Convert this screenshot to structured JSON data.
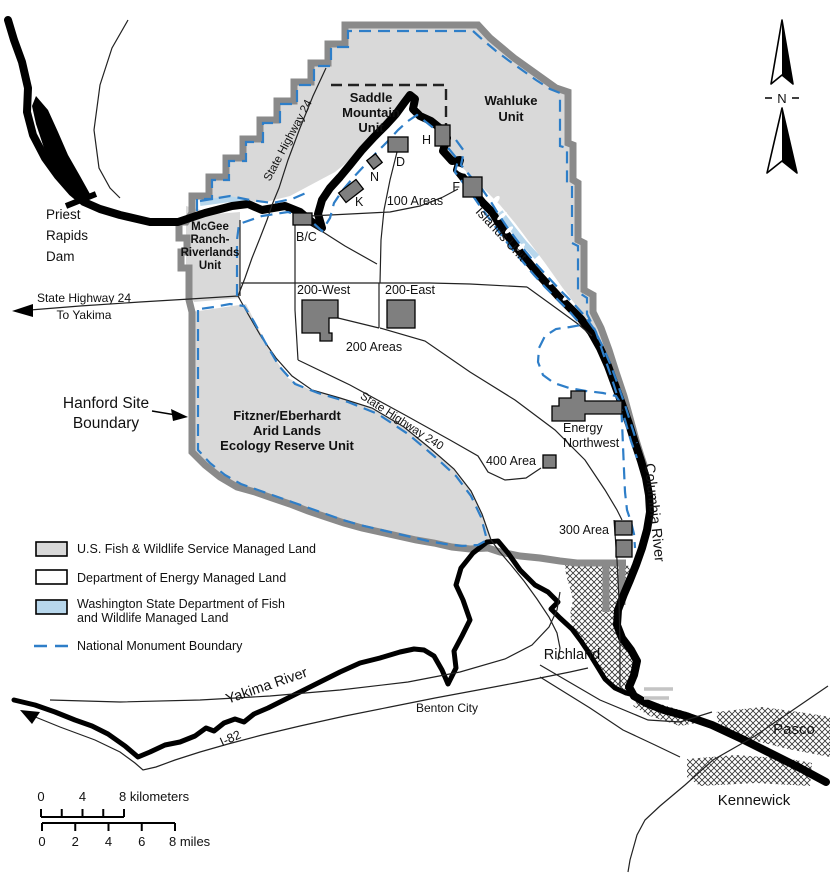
{
  "title": "Hanford Site map",
  "compass": {
    "n": "N"
  },
  "units": {
    "saddle": [
      "Saddle",
      "Mountain",
      "Unit"
    ],
    "wahluke": [
      "Wahluke",
      "Unit"
    ],
    "mcgee": [
      "McGee",
      "Ranch-",
      "Riverlands",
      "Unit"
    ],
    "fitzner": [
      "Fitzner/Eberhardt",
      "Arid Lands",
      "Ecology Reserve Unit"
    ],
    "islands": "Islands Unit"
  },
  "areas": {
    "a100": "100 Areas",
    "a200": "200 Areas",
    "w200": "200-West",
    "e200": "200-East",
    "a400": "400 Area",
    "a300": "300 Area",
    "energy": [
      "Energy",
      "Northwest"
    ],
    "reactors": {
      "bc": "B/C",
      "k": "K",
      "n": "N",
      "d": "D",
      "h": "H",
      "f": "F"
    }
  },
  "water": {
    "columbia": "Columbia River",
    "yakima": "Yakima River",
    "dam": [
      "Priest",
      "Rapids",
      "Dam"
    ]
  },
  "roads": {
    "hwy24_rotated": "State Highway 24",
    "hwy24_west": "State Highway 24",
    "to_yakima": "To Yakima",
    "hwy240": "State Highway 240",
    "i82": "I-82"
  },
  "cities": {
    "richland": "Richland",
    "benton": "Benton City",
    "pasco": "Pasco",
    "kennewick": "Kennewick"
  },
  "callout": {
    "line1": "Hanford Site",
    "line2": "Boundary"
  },
  "legend": {
    "fws": "U.S. Fish & Wildlife Service Managed Land",
    "doe": "Department of Energy Managed Land",
    "wdfw_line1": "Washington State Department of Fish",
    "wdfw_line2": "and Wildlife Managed Land",
    "monument": "National Monument Boundary"
  },
  "scale": {
    "km": [
      "0",
      "4",
      "8 kilometers"
    ],
    "miles": [
      "0",
      "2",
      "4",
      "6",
      "8 miles"
    ]
  },
  "colors": {
    "fws_land": "#d9d9d9",
    "site_boundary": "#8a8a8a",
    "monument_blue": "#2e7ec8",
    "wdfw_blue": "#b8d7ec",
    "facility_gray": "#7f7f7f",
    "river_black": "#000000"
  }
}
